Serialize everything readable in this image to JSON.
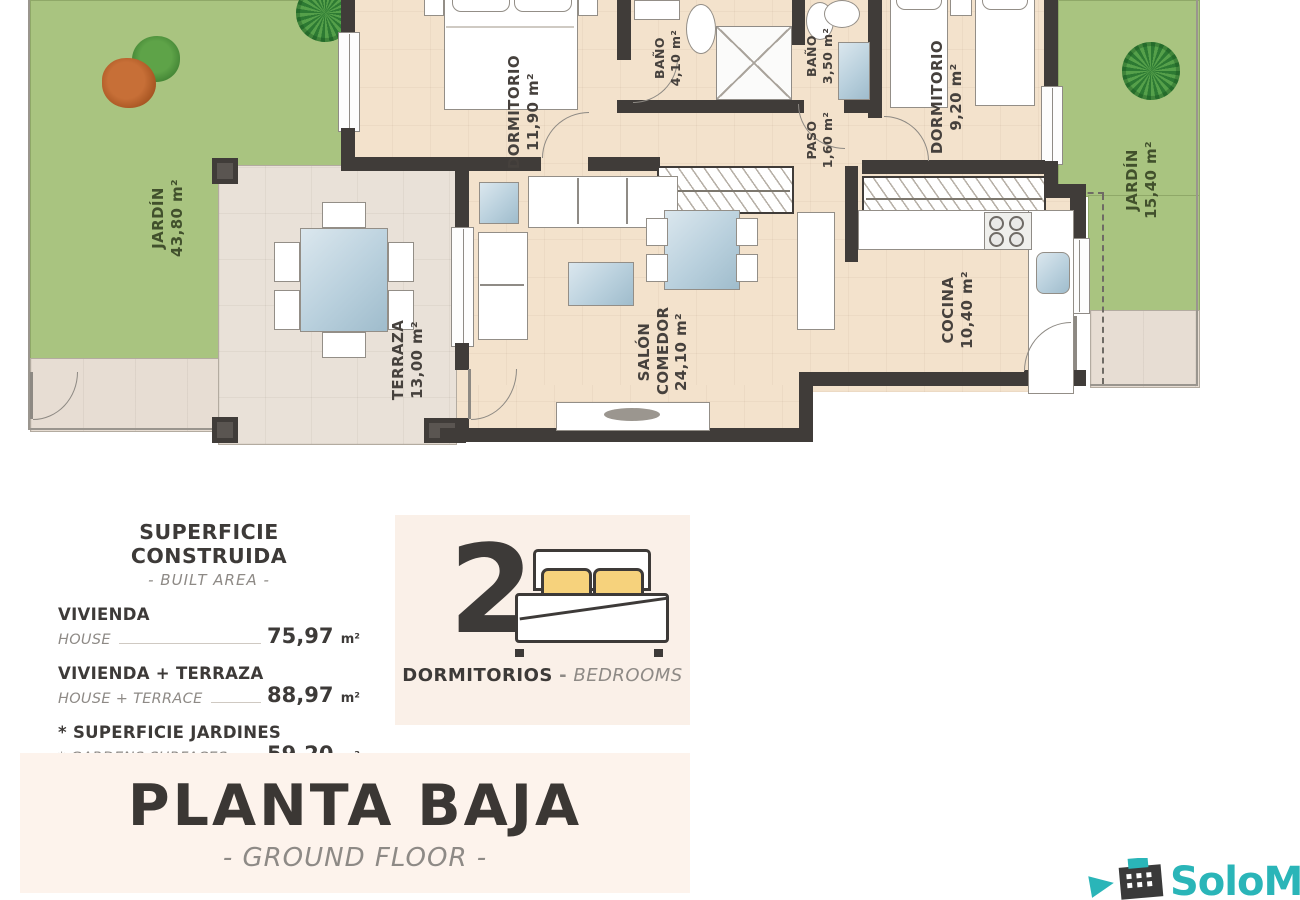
{
  "plan": {
    "garden_left": {
      "name": "JARDÍN",
      "area": "43,80 m²"
    },
    "terrace": {
      "name": "TERRAZA",
      "area": "13,00 m²"
    },
    "bedroom_main": {
      "name": "DORMITORIO",
      "area": "11,90 m²"
    },
    "bath_1": {
      "name": "BAÑO",
      "area": "4,10 m²"
    },
    "bath_2": {
      "name": "BAÑO",
      "area": "3,50 m²"
    },
    "bedroom_2": {
      "name": "DORMITORIO",
      "area": "9,20 m²"
    },
    "hall": {
      "name": "PASO",
      "area": "1,60 m²"
    },
    "living": {
      "name": "SALÓN COMEDOR",
      "area": "24,10 m²"
    },
    "kitchen": {
      "name": "COCINA",
      "area": "10,40 m²"
    },
    "garden_right": {
      "name": "JARDÍN",
      "area": "15,40 m²"
    }
  },
  "legend": {
    "title": "SUPERFICIE CONSTRUIDA",
    "subtitle": "- BUILT AREA -",
    "rows": [
      {
        "label_es": "VIVIENDA",
        "label_en": "HOUSE",
        "value": "75,97",
        "unit": "m²"
      },
      {
        "label_es": "VIVIENDA + TERRAZA",
        "label_en": "HOUSE + TERRACE",
        "value": "88,97",
        "unit": "m²"
      },
      {
        "label_es": "* SUPERFICIE JARDINES",
        "label_en": "* GARDENS SURFACES",
        "value": "59,20",
        "unit": "m²"
      }
    ]
  },
  "bedrooms_badge": {
    "count": "2",
    "label_es": "DORMITORIOS",
    "separator": "-",
    "label_en": "BEDROOMS"
  },
  "floor_title": {
    "title": "PLANTA BAJA",
    "subtitle": "- GROUND FLOOR -"
  },
  "logo": {
    "brand": "SoloMar"
  },
  "colors": {
    "wall": "#403c39",
    "garden": "#a9c480",
    "floor": "#f3e2cc",
    "terrace_floor": "#e9e1d8",
    "pavement": "#e7ddd3",
    "glass": "#b9d0dd",
    "pillow_yellow": "#f6d27c",
    "badge_bg": "#faf0e8",
    "panel_bg": "#fdf3ec",
    "accent_teal": "#2ab5b8",
    "text_dark": "#3d3a38",
    "text_grey": "#8e8a86"
  }
}
